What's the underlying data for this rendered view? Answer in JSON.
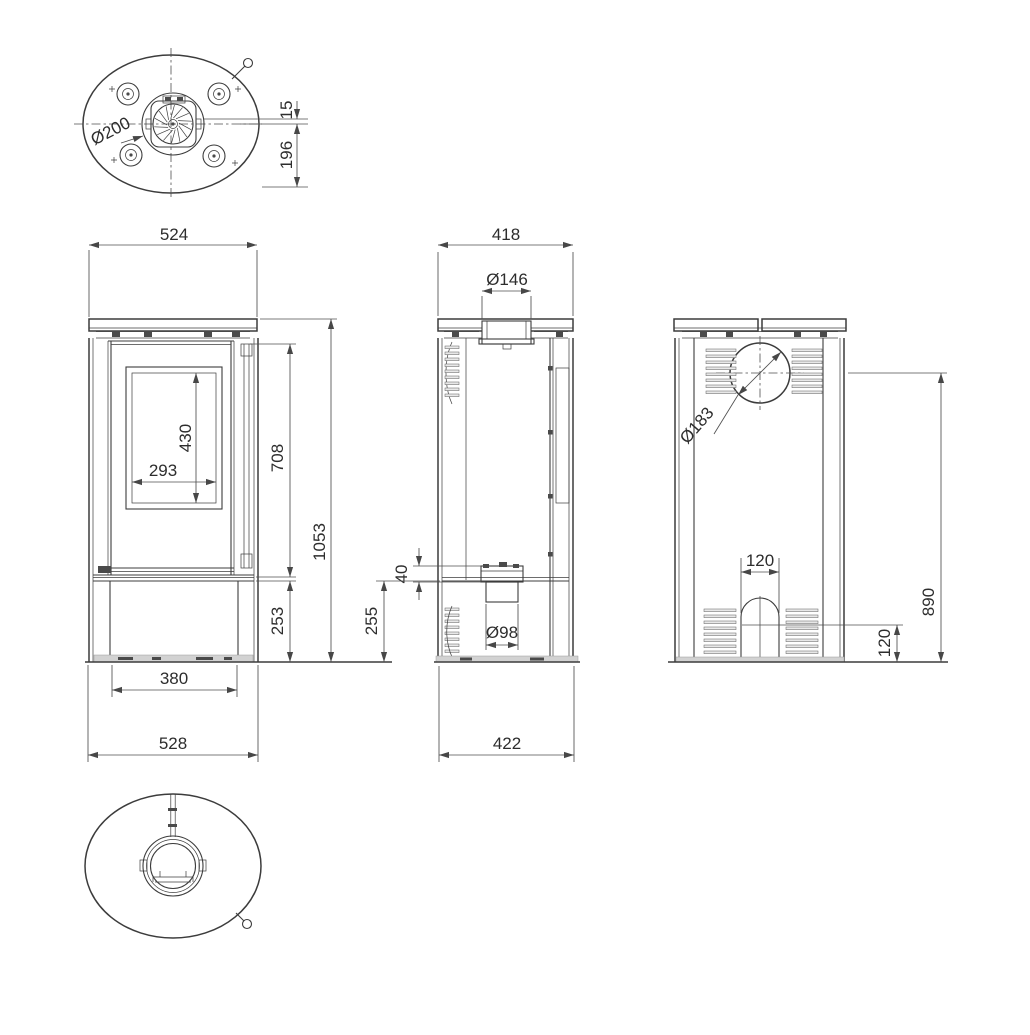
{
  "colors": {
    "line": "#3c3c3c",
    "dim_line": "#4f4f4f",
    "text": "#2d2d2d",
    "background": "#ffffff",
    "vent_fill": "#e8e8e8",
    "floor_fill": "#d2d2d2"
  },
  "views": {
    "top": {
      "dims": {
        "flue_diameter": "Ø200",
        "flue_offset": "15",
        "flue_to_rear": "196"
      }
    },
    "front": {
      "dims": {
        "top_plate_width": "524",
        "glass_height": "430",
        "glass_width": "293",
        "upper_section_height": "708",
        "overall_height": "1053",
        "pedestal_height": "253",
        "base_width": "380",
        "overall_width": "528"
      }
    },
    "side": {
      "dims": {
        "top_plate_depth": "418",
        "flue_collar_diameter": "Ø146",
        "inlet_flange_height": "40",
        "pedestal_height": "255",
        "air_inlet_diameter": "Ø98",
        "overall_depth": "422"
      }
    },
    "rear": {
      "dims": {
        "flue_diameter": "Ø183",
        "flue_center_height": "890",
        "arch_width": "120",
        "arch_height": "120"
      }
    }
  }
}
